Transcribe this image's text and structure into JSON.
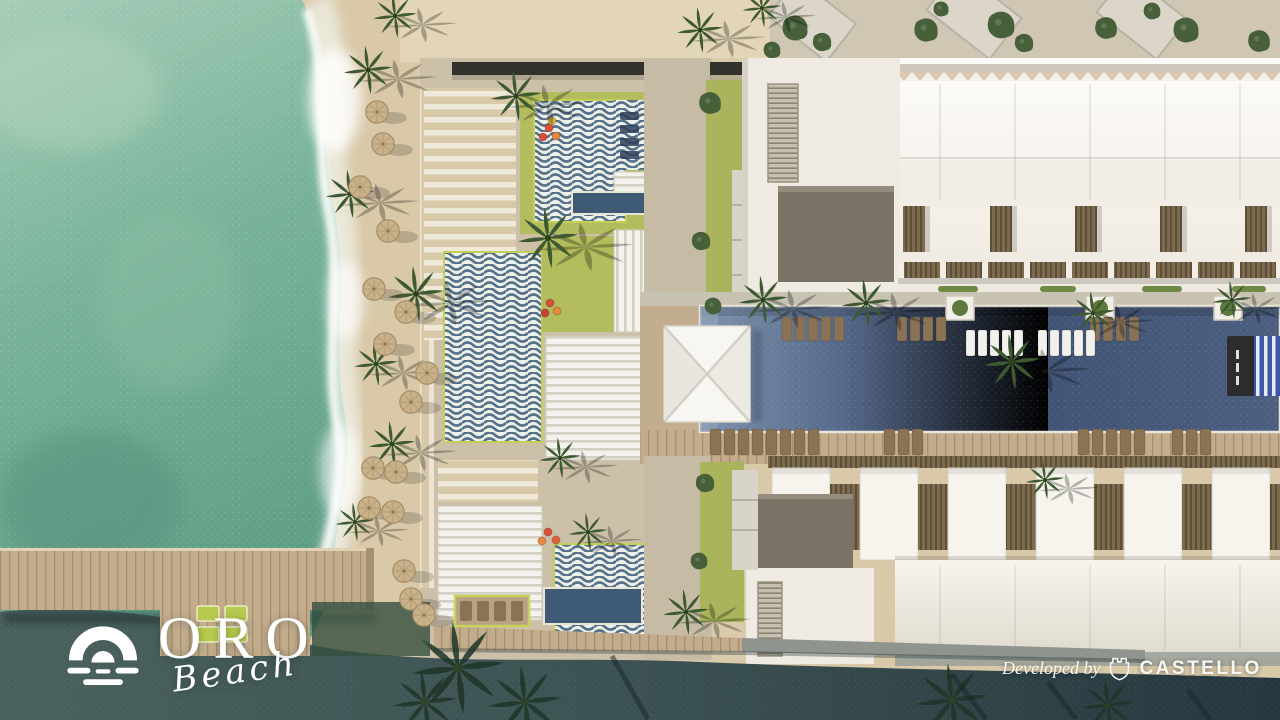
{
  "branding": {
    "logo_name": "ORO",
    "logo_script": "Beach",
    "logo_icon": "sun-over-waves",
    "developer_prefix": "Developed by",
    "developer_name": "CASTELLO",
    "developer_icon": "castle-shield"
  },
  "colors": {
    "sea": "#6fae94",
    "sea_light": "#a7ccb8",
    "foam": "#f2f5ee",
    "sand": "#d9c9a9",
    "sand_light": "#e4d7ba",
    "deck": "#ccc0a9",
    "lawn": "#b3bd5d",
    "pool": "#4d5f80",
    "pool_light": "#8299b3",
    "small_pool": "#3e5a74",
    "building": "#f4f1ea",
    "roof_box": "#7b7266",
    "balcony_wood": "#7d6b50",
    "wood_deck": "#bca387",
    "pier": "#c2ac8c",
    "dark_water": "#3c5152",
    "dark_water_deep": "#26383f",
    "palm": "#3f5a33",
    "canopy_dark": "#32312c",
    "text": "#ffffff"
  }
}
